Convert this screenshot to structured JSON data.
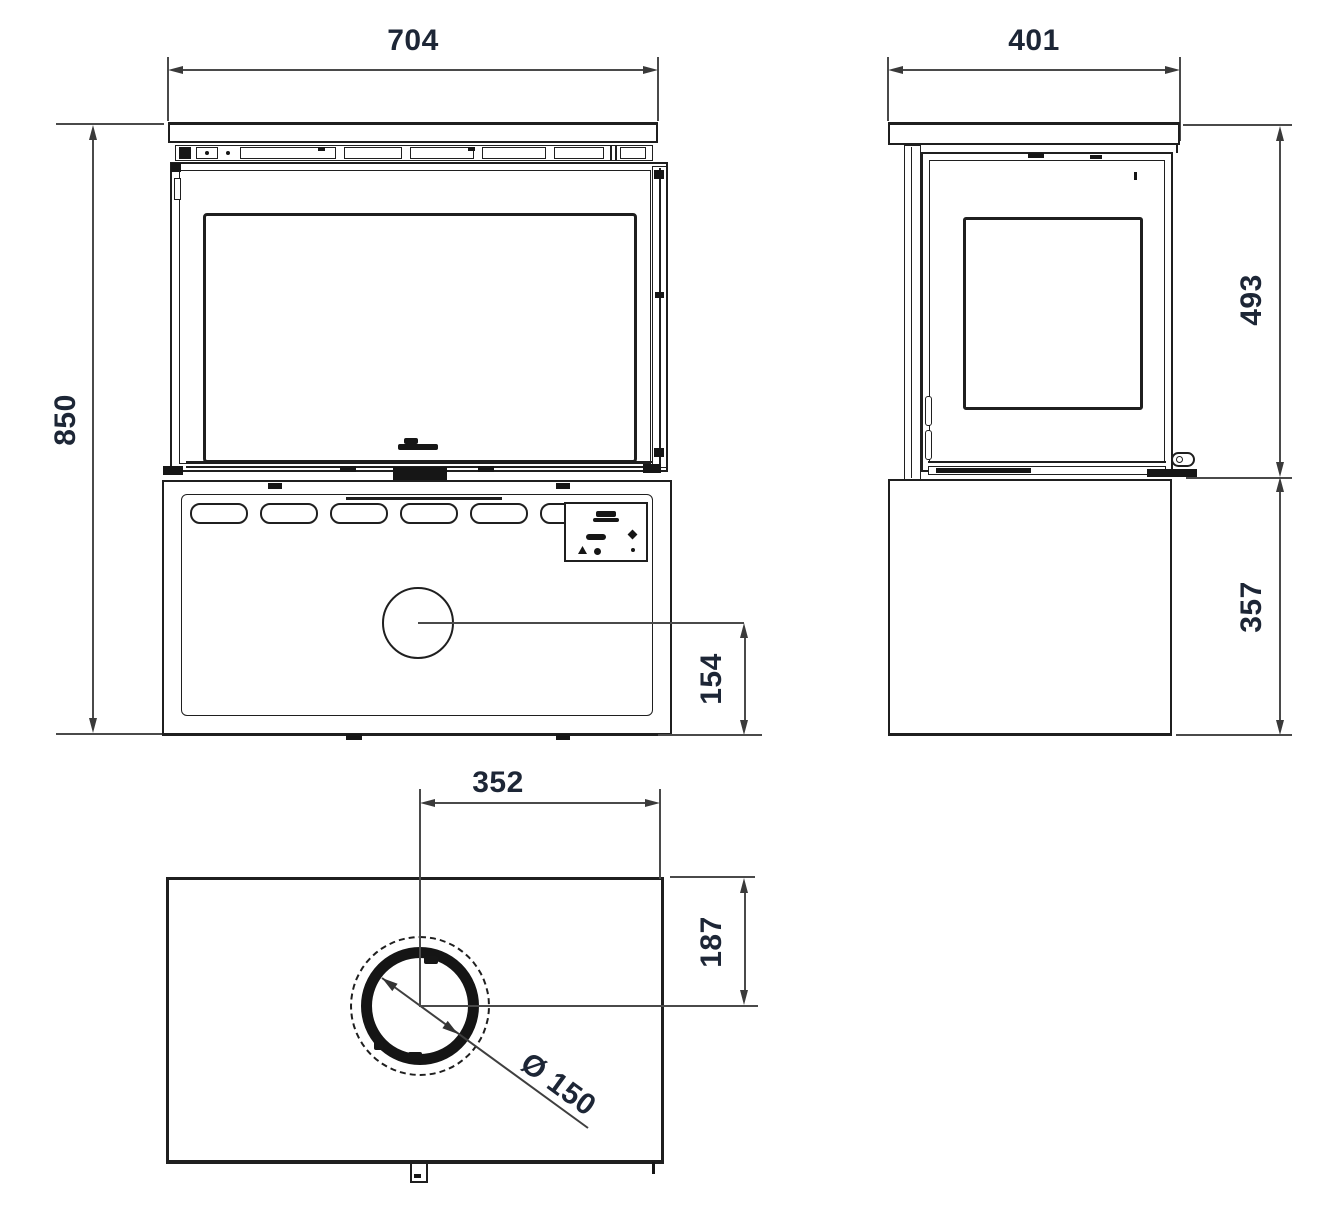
{
  "colors": {
    "background": "#ffffff",
    "object_line": "#1f1f1f",
    "dimension_line": "#4a4a4a",
    "dimension_text": "#1d2636"
  },
  "views": {
    "front": {
      "width_mm": "704",
      "height_mm": "850",
      "flue_center_to_base_mm": "154"
    },
    "side": {
      "depth_mm": "401",
      "upper_height_mm": "493",
      "base_height_mm": "357"
    },
    "top": {
      "flue_center_to_edge_mm": "352",
      "flue_center_to_back_mm": "187",
      "flue_diameter": "Ø 150"
    }
  }
}
